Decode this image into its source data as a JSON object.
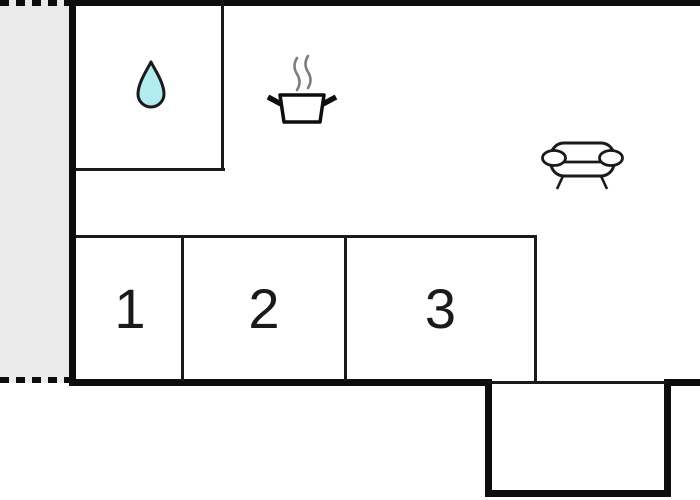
{
  "bedrooms": [
    {
      "label": "1"
    },
    {
      "label": "2"
    },
    {
      "label": "3"
    }
  ],
  "icons": {
    "bathroom": "water-drop-icon",
    "kitchen": "cooking-pot-icon",
    "living": "sofa-icon"
  },
  "colors": {
    "background": "#ffffff",
    "wall": "#0d0d0d",
    "thin_line": "#1a1a1a",
    "terrace_fill": "#eaeaea",
    "drop_fill": "#b2ecee",
    "steam_gray": "#7d7d7d"
  }
}
